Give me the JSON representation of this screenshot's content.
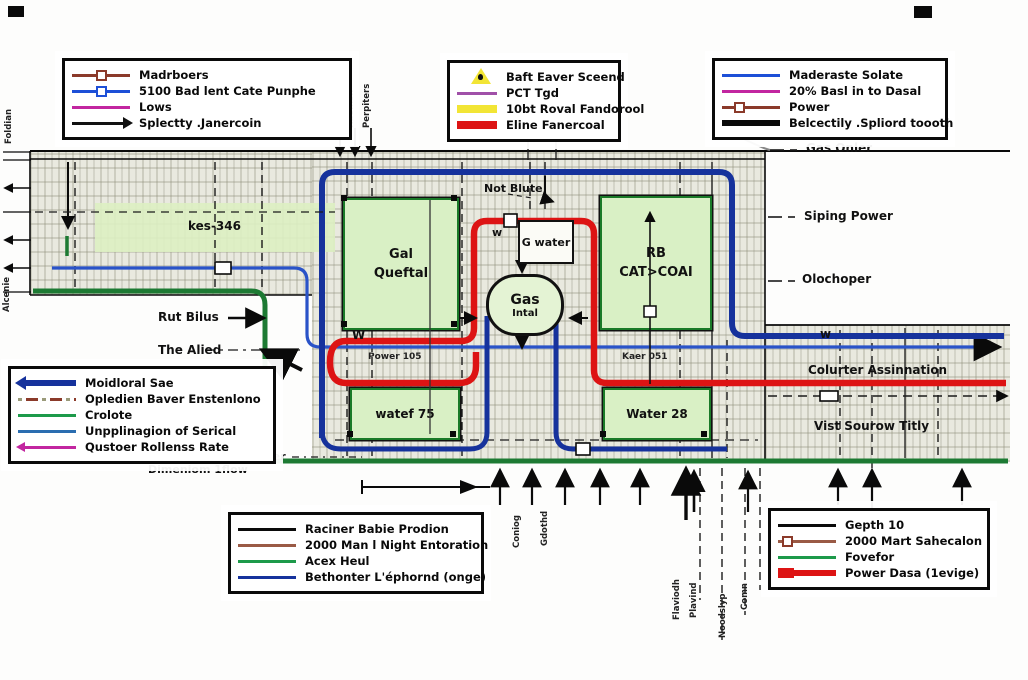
{
  "colors": {
    "pipe_blue": "#16329c",
    "pipe_blue_thin": "#2a53c8",
    "pipe_red": "#dd1414",
    "pipe_green": "#1d7a33",
    "magenta": "#c226a0",
    "purple": "#a050a8",
    "brown": "#8b3a2a",
    "yellow": "#f2e535",
    "black": "#0a0a0a",
    "hatch_bg": "#e9e9df",
    "block_green": "#d9f0c5"
  },
  "legends": {
    "top_left": {
      "items": [
        {
          "swatch": "brown-square-line",
          "label": "Madrboers"
        },
        {
          "swatch": "blue-square-line",
          "label": "5100 Bad lent Cate Punphe"
        },
        {
          "swatch": "magenta-line",
          "label": "Lows"
        },
        {
          "swatch": "black-arrow-line",
          "label": "Splectty .Janercoin"
        }
      ]
    },
    "top_middle": {
      "items": [
        {
          "swatch": "warning-triangle",
          "label": "Baft Eaver Sceend"
        },
        {
          "swatch": "purple-line",
          "label": "PCT Tgd"
        },
        {
          "swatch": "yellow-bar",
          "label": "10bt Roval Fandorool"
        },
        {
          "swatch": "red-bar",
          "label": "Eline Fanercoal"
        }
      ]
    },
    "top_right": {
      "items": [
        {
          "swatch": "blue-line",
          "label": "Maderaste Solate"
        },
        {
          "swatch": "magenta-line",
          "label": "20% Basl in to Dasal"
        },
        {
          "swatch": "brown-square-line",
          "label": "Power"
        },
        {
          "swatch": "black-thick-line",
          "label": "Belcectily .Spliord toooth"
        }
      ]
    },
    "mid_left": {
      "items": [
        {
          "swatch": "blue-arrow-left",
          "label": "Moidloral Sae"
        },
        {
          "swatch": "dashed-brown-line",
          "label": "Opledien Baver Enstenlono"
        },
        {
          "swatch": "green-line",
          "label": "Crolote"
        },
        {
          "swatch": "blue-thin-line",
          "label": "Unpplinagion of Serical"
        },
        {
          "swatch": "magenta-arrow-left",
          "label": "Qustoer Rollenss Rate"
        }
      ]
    },
    "bottom_middle": {
      "items": [
        {
          "swatch": "black-line",
          "label": "Raciner Babie Prodion"
        },
        {
          "swatch": "brown-line",
          "label": "2000 Man l Night Entoration"
        },
        {
          "swatch": "green-line",
          "label": "Acex Heul"
        },
        {
          "swatch": "blue-line",
          "label": "Bethonter L'éphornd (onge)"
        }
      ]
    },
    "bottom_right": {
      "items": [
        {
          "swatch": "black-line",
          "label": "Gepth 10"
        },
        {
          "swatch": "brown-square-line",
          "label": "2000 Mart Sahecalon"
        },
        {
          "swatch": "green-line",
          "label": "Fovefor"
        },
        {
          "swatch": "red-thick-line",
          "label": "Power Dasa (1evige)"
        }
      ]
    }
  },
  "blocks": {
    "gal": {
      "line1": "Gal",
      "line2": "Queftal"
    },
    "rb": {
      "line1": "RB",
      "line2": "CAT>COAI"
    },
    "water75": {
      "label": "watef 75"
    },
    "water28": {
      "label": "Water 28"
    },
    "gwater": {
      "label": "G water"
    },
    "gas": {
      "line1": "Gas",
      "line2": "Intal"
    }
  },
  "map_labels": {
    "kes_band": "kes-346",
    "not_blute": "Not Blute",
    "w_small": "w",
    "w_left": "W",
    "w_right": "w",
    "power_105": "Power 105",
    "kaer_051": "Kaer 051",
    "rut_bilus": "Rut Bilus",
    "the_alied": "The Alied",
    "gas_onler": "Gas Onler",
    "siping_power": "Siping Power",
    "olochoper": "Olochoper",
    "colurter": "Colurter Assinnation",
    "vist": "Vist Sourow Titly",
    "cover": "Cover",
    "dimeniom": "Dimeniom 1flow"
  },
  "vertical_labels": {
    "top_1": "Ranolion",
    "top_2": "Raoinsn",
    "top_3": "Perpiters",
    "left_1": "Foldian",
    "left_2": "Alcenie",
    "bottom_1": "Coniog",
    "bottom_2": "Gdothd",
    "bottom_3": "Flaviodh",
    "bottom_4": "Plavind",
    "bottom_5": "Noodslyp",
    "bottom_6": "Comn"
  }
}
